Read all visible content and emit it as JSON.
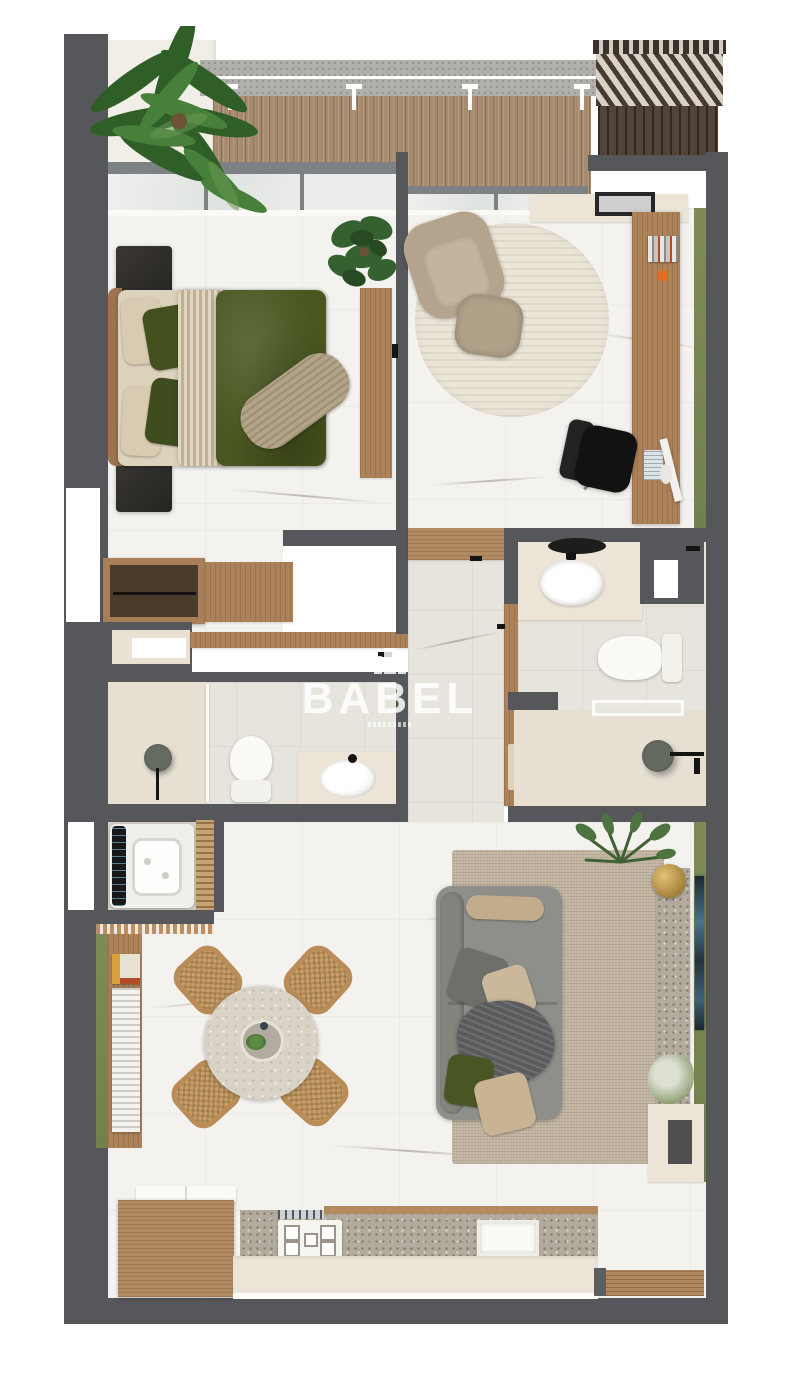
{
  "watermark": {
    "label": "BABEL",
    "icon": "building-icon"
  },
  "scene": {
    "type": "3d-floor-plan-top-view",
    "unit": "one-bedroom apartment"
  },
  "palette": {
    "wall": "#56575a",
    "floor_marble": "#f4f2ee",
    "floor_bath": "#e7e4dd",
    "wood_light": "#c7a274",
    "wood_mid": "#ad8259",
    "wood_dark": "#53443a",
    "deck": "#a78b6f",
    "green_accent": "#7e8b57",
    "bed_green": "#49561f",
    "linen_beige": "#d3c5ab",
    "sofa_gray": "#8e8e8a",
    "rug_living": "#c1b5a1",
    "rug_office": "#ebe5d8",
    "terrazzo": "#b2aa9c",
    "cream": "#ece5d7",
    "fixture_black": "#1c1c1c",
    "watermark_white": "rgba(255,255,255,0.78)"
  },
  "rooms": [
    {
      "name": "balcony",
      "furniture": [
        "wood-deck",
        "concrete-ledge",
        "palm-plant",
        "pergola",
        "railing-lights"
      ]
    },
    {
      "name": "bedroom",
      "furniture": [
        "double-bed",
        "nightstand-left",
        "nightstand-right",
        "tv-console",
        "monstera-plant",
        "open-wardrobe",
        "dresser"
      ]
    },
    {
      "name": "home-office",
      "furniture": [
        "desk",
        "office-chair",
        "armchair",
        "ottoman",
        "round-rug",
        "monitor",
        "keyboard",
        "books",
        "console-shelf",
        "picture-frame"
      ]
    },
    {
      "name": "ensuite-bathroom",
      "furniture": [
        "vanity-sink",
        "round-mirror",
        "toilet",
        "walk-in-shower",
        "window-niche"
      ]
    },
    {
      "name": "bathroom",
      "furniture": [
        "walk-in-shower",
        "toilet",
        "vanity-sink",
        "window-niche"
      ]
    },
    {
      "name": "hallway",
      "furniture": [
        "wood-shelf",
        "open-doors"
      ]
    },
    {
      "name": "laundry-closet",
      "furniture": [
        "washing-machine",
        "slatted-door"
      ]
    },
    {
      "name": "dining-area",
      "furniture": [
        "round-stone-table",
        "rattan-chair",
        "rattan-chair",
        "rattan-chair",
        "rattan-chair",
        "book-ledge"
      ]
    },
    {
      "name": "living-room",
      "furniture": [
        "sofa",
        "area-rug",
        "wall-tv",
        "terrazzo-ledge",
        "brass-bowl",
        "plants",
        "tv-cabinet"
      ]
    },
    {
      "name": "kitchen",
      "furniture": [
        "island",
        "cooktop",
        "utensil-rail",
        "sink",
        "terrazzo-counter",
        "entry-mat"
      ]
    }
  ]
}
